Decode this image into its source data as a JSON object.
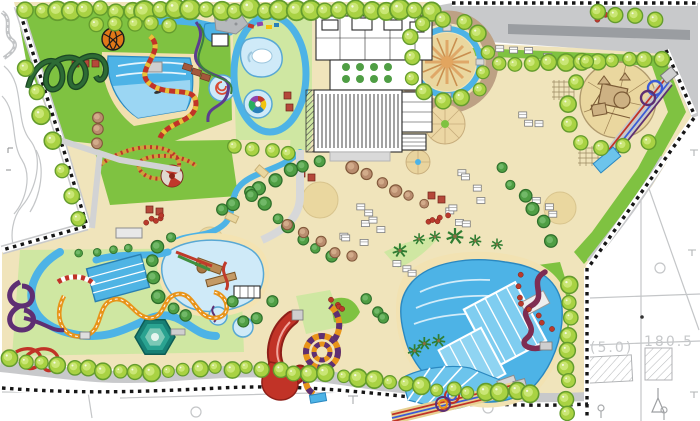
{
  "map": {
    "kind": "water-theme-park-masterplan"
  },
  "annotations": {
    "elevation_note": "84.1",
    "offset_note": "(5.0)",
    "length_note": "180.5"
  },
  "palette": {
    "tan": "#f0e4bb",
    "sand": "#ead79f",
    "plaza": "#bda184",
    "lawn": "#7fc241",
    "lawnpale": "#cfe7a2",
    "water": "#4db3e6",
    "waterlight": "#a9dcf5",
    "pool": "#cfeaf8",
    "poolstroke": "#58a8d4",
    "road": "#c8c9cb",
    "roaddark": "#9a9da1",
    "ink": "#2b2b2b",
    "survey": "#c4c6c8",
    "label": "#c6c8ca",
    "treefill": "#a9d243",
    "treehi": "#cde87b",
    "treestroke": "#649c2d",
    "treedark": "#4f9e44",
    "treedarkstroke": "#2e6e2b",
    "brown": "#b98d6f",
    "brownstroke": "#80583a",
    "red": "#c13327",
    "orange": "#e8941a",
    "purple": "#5e2f73",
    "maroon": "#7e2d52",
    "ridegreen": "#2d6b35",
    "yellow": "#e7c23a",
    "blue": "#3b5bd6",
    "dome": "#e07818"
  }
}
